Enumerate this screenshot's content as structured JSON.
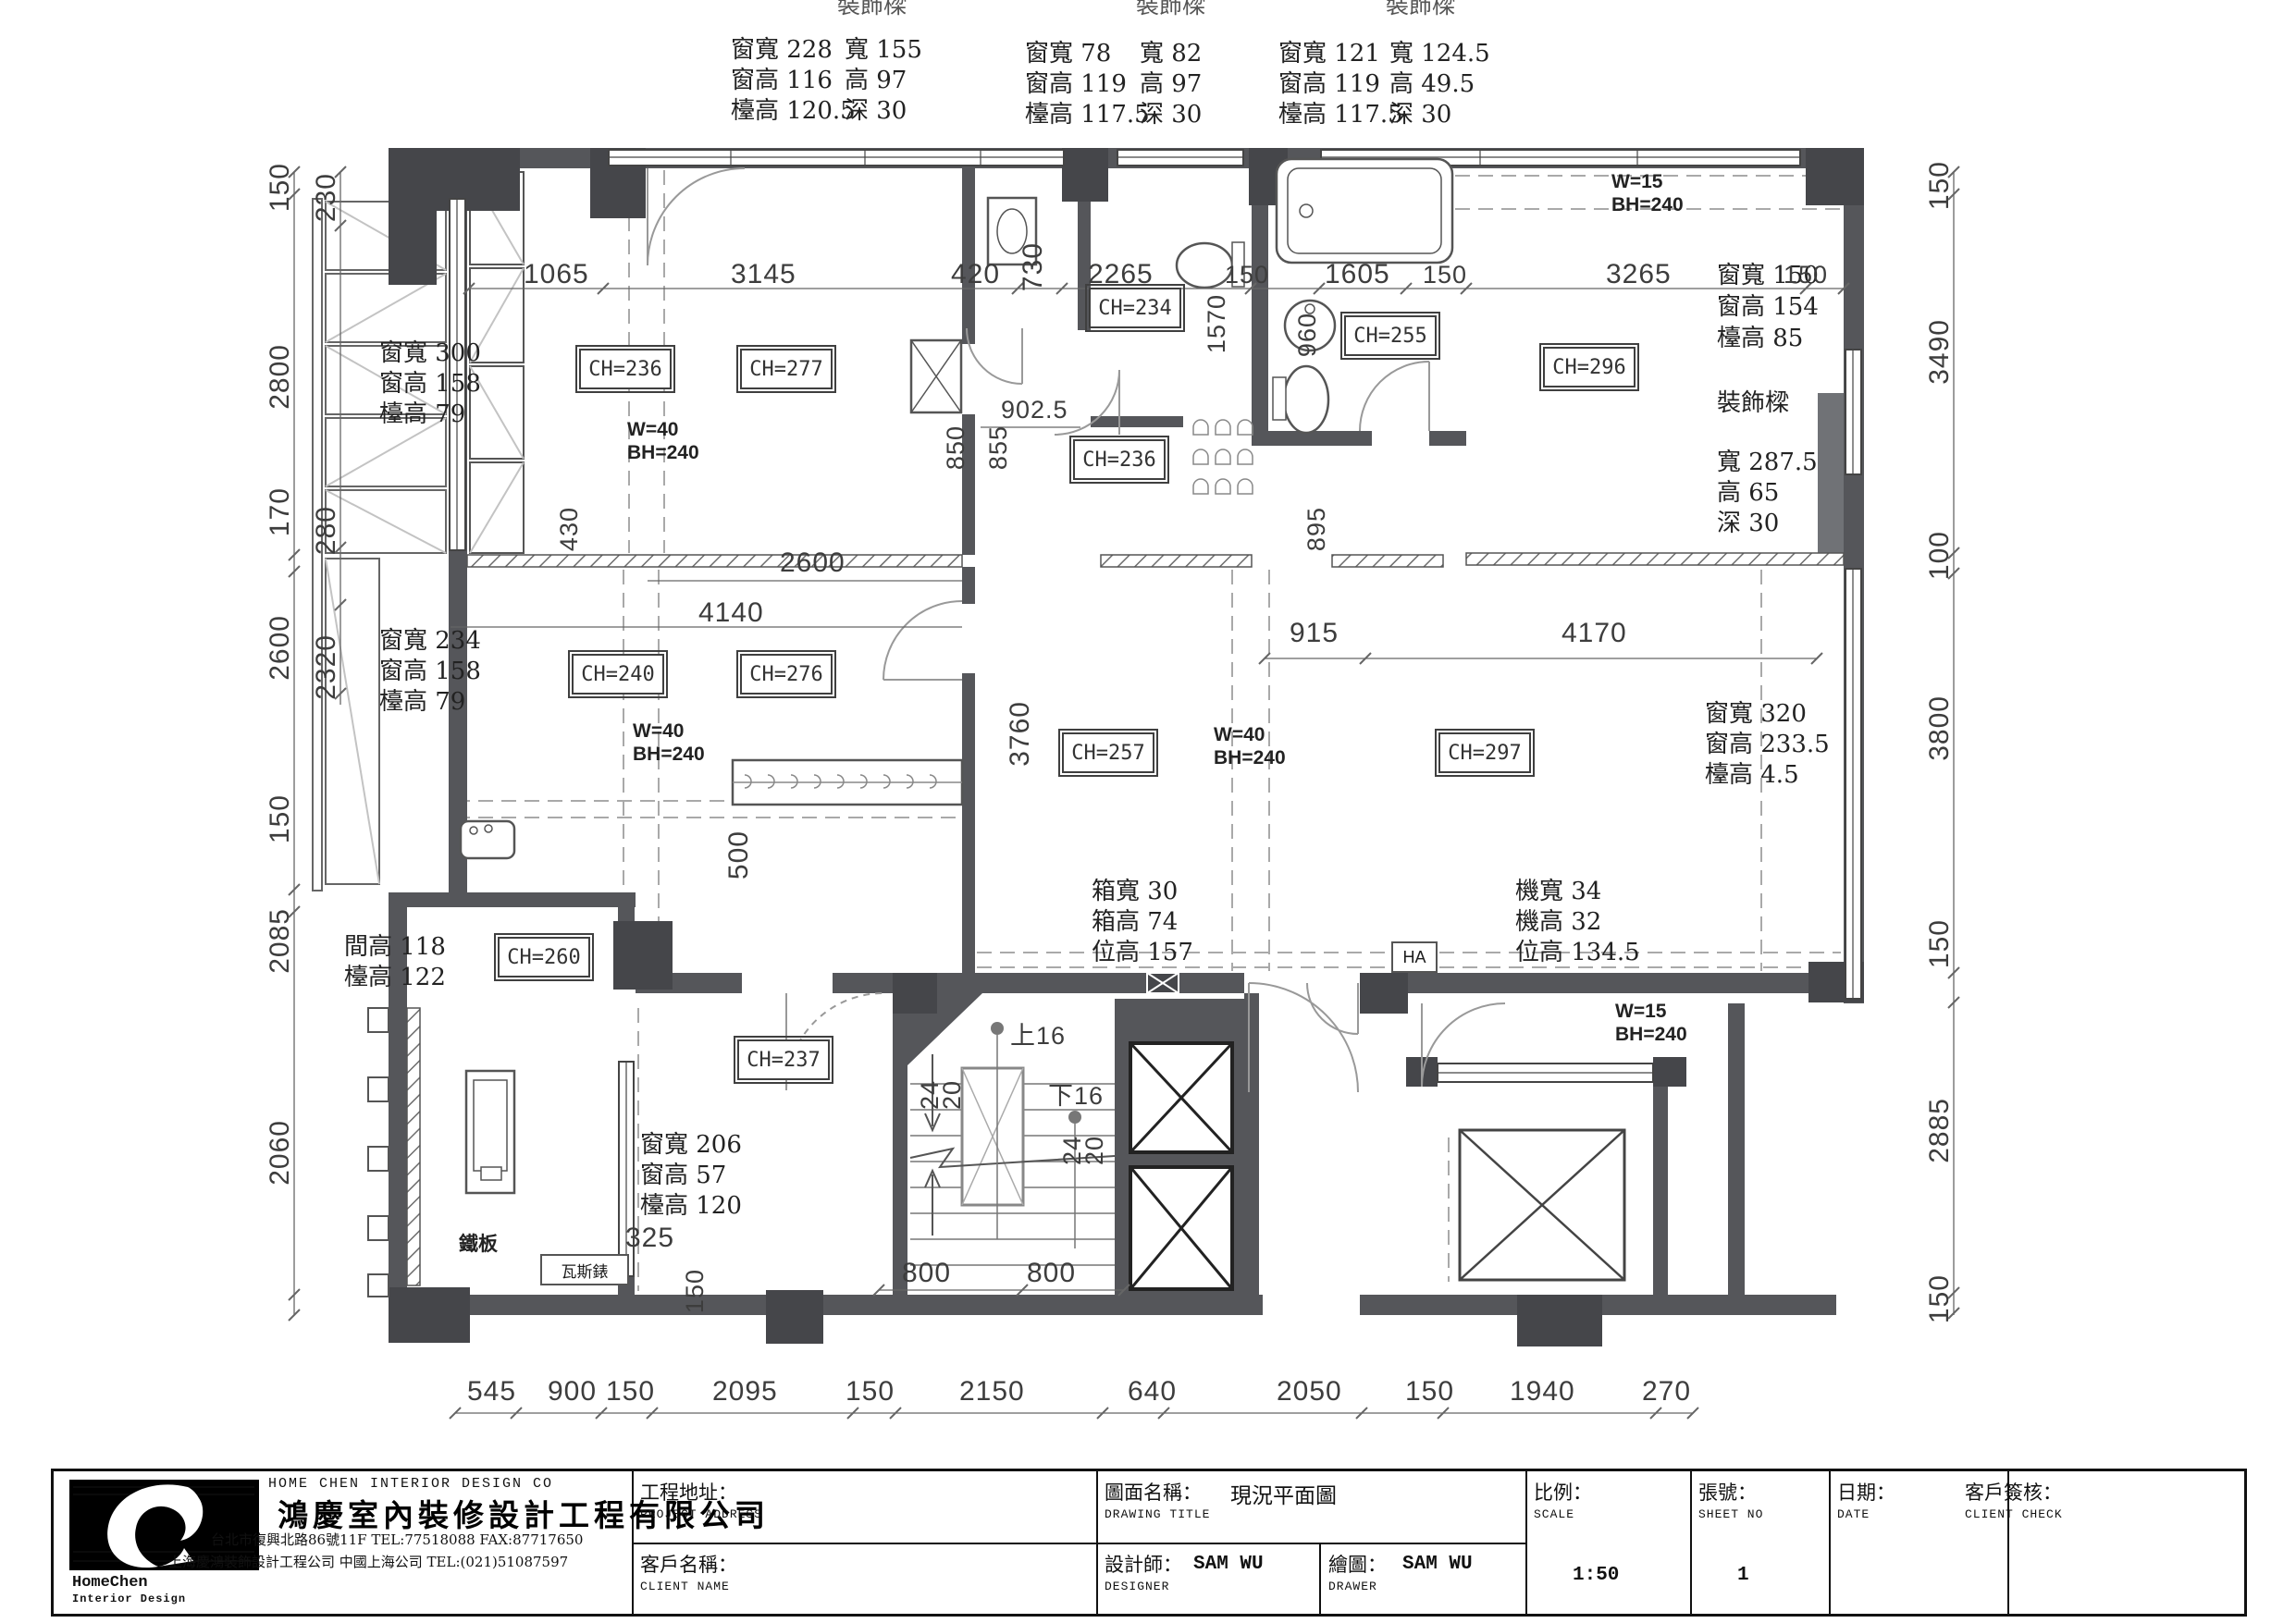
{
  "plan": {
    "win_top": [
      {
        "beam_header": "裝飾樑",
        "rows": [
          "窗寬 228",
          "窗高 116",
          "檯高 120.5"
        ],
        "beam": [
          "寬 155",
          "高 97",
          "深 30"
        ]
      },
      {
        "beam_header": "裝飾樑",
        "rows": [
          "窗寬 78",
          "窗高 119",
          "檯高 117.5"
        ],
        "beam": [
          "寬 82",
          "高 97",
          "深 30"
        ]
      },
      {
        "beam_header": "裝飾樑",
        "rows": [
          "窗寬 121",
          "窗高 119",
          "檯高 117.5"
        ],
        "beam": [
          "寬 124.5",
          "高 49.5",
          "深 30"
        ]
      }
    ],
    "win_left_upper": [
      "窗寬 300",
      "窗高 158",
      "檯高 79"
    ],
    "win_left_lower": [
      "窗寬 234",
      "窗高 158",
      "檯高 79"
    ],
    "gap_left": [
      "間高 118",
      "檯高 122"
    ],
    "win_kitchen": [
      "窗寬 206",
      "窗高 57",
      "檯高 120"
    ],
    "iron_plate": "鐵板",
    "gas_meter": "瓦斯錶",
    "win_right_upper": [
      "窗寬 150",
      "窗高 154",
      "檯高 85"
    ],
    "beam_right": {
      "title": "裝飾樑",
      "rows": [
        "寬 287.5",
        "高 65",
        "深 30"
      ]
    },
    "win_right_lower": [
      "窗寬 320",
      "窗高 233.5",
      "檯高 4.5"
    ],
    "box_unit": [
      "箱寬 30",
      "箱高 74",
      "位高 157"
    ],
    "machine_unit": [
      "機寬 34",
      "機高 32",
      "位高 134.5"
    ],
    "ha_label": "HA",
    "ch_labels": [
      "CH=236",
      "CH=277",
      "CH=234",
      "CH=236",
      "CH=255",
      "CH=296",
      "CH=240",
      "CH=276",
      "CH=257",
      "CH=297",
      "CH=260",
      "CH=237"
    ],
    "beam_tags": {
      "w40": "W=40",
      "w15": "W=15",
      "bh240": "BH=240"
    },
    "stairs": {
      "up": "上16",
      "down": "下16",
      "r20": "20",
      "r24": "24",
      "d800": "800"
    },
    "dims": {
      "top": [
        "1065",
        "3145",
        "730",
        "420",
        "2265",
        "150",
        "1605",
        "150",
        "3265",
        "150"
      ],
      "left": [
        "150",
        "230",
        "2800",
        "170",
        "280",
        "2600",
        "2320",
        "150",
        "2085",
        "2060"
      ],
      "right": [
        "150",
        "3490",
        "100",
        "3800",
        "150",
        "2885",
        "150"
      ],
      "bottom": [
        "545",
        "900",
        "150",
        "2095",
        "150",
        "2150",
        "640",
        "2050",
        "150",
        "1940",
        "270"
      ],
      "inner": {
        "d2600": "2600",
        "d4140": "4140",
        "d915": "915",
        "d4170": "4170",
        "d3760": "3760",
        "d500": "500",
        "d902": "902.5",
        "d850": "850",
        "d855": "855",
        "d1570": "1570",
        "d960": "960",
        "d895": "895",
        "d430": "430",
        "d325": "325",
        "d150": "150"
      }
    }
  },
  "title_block": {
    "company_en": "HOME CHEN INTERIOR DESIGN CO",
    "company_cjk": "鴻慶室內裝修設計工程有限公司",
    "address_tw": "台北市復興北路86號11F TEL:77518088 FAX:87717650",
    "address_sh": "上海慶鴻裝飾設計工程公司 中國上海公司 TEL:(021)51087597",
    "logo_text_1": "HomeChen",
    "logo_text_2": "Interior Design",
    "fields": {
      "project_address_label": "工程地址：",
      "project_address_sub": "PROJECT ADDRESS",
      "client_name_label": "客戶名稱：",
      "client_name_sub": "CLIENT NAME",
      "drawing_title_label": "圖面名稱：",
      "drawing_title_sub": "DRAWING TITLE",
      "drawing_title_value": "現況平面圖",
      "designer_label": "設計師：",
      "designer_sub": "DESIGNER",
      "designer_value": "SAM WU",
      "drawer_label": "繪圖：",
      "drawer_sub": "DRAWER",
      "drawer_value": "SAM WU",
      "scale_label": "比例：",
      "scale_sub": "SCALE",
      "scale_value": "1:50",
      "sheet_label": "張號：",
      "sheet_sub": "SHEET NO",
      "sheet_value": "1",
      "date_label": "日期：",
      "date_sub": "DATE",
      "client_check_label": "客戶簽核：",
      "client_check_sub": "CLIENT CHECK"
    }
  }
}
